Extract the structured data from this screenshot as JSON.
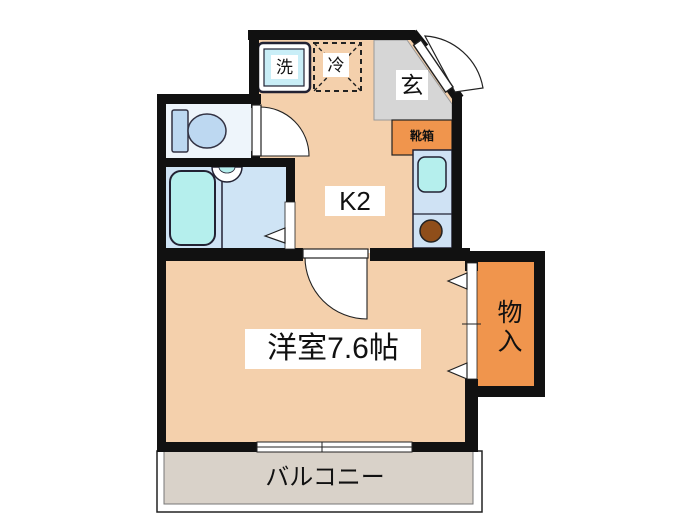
{
  "floorplan": {
    "labels": {
      "washer": "洗",
      "fridge": "冷",
      "entrance": "玄",
      "shoe_box": "靴箱",
      "kitchen": "K2",
      "main_room": "洋室7.6帖",
      "storage": "物入",
      "balcony": "バルコニー"
    },
    "colors": {
      "wall": "#111111",
      "floor": "#f4d0ac",
      "genkan": "#d6d6d6",
      "balcony": "#d9d2c9",
      "accent_orange": "#f0954d",
      "bath_floor": "#cfe4f5",
      "fixture_cyan": "#b5efed",
      "counter_blue": "#cfe2f4",
      "toilet_room": "#eef5fb",
      "toilet_fixture": "#bdd8f1",
      "washer_cyan": "#c9eef7",
      "burner_brown": "#8f4e1a"
    }
  }
}
